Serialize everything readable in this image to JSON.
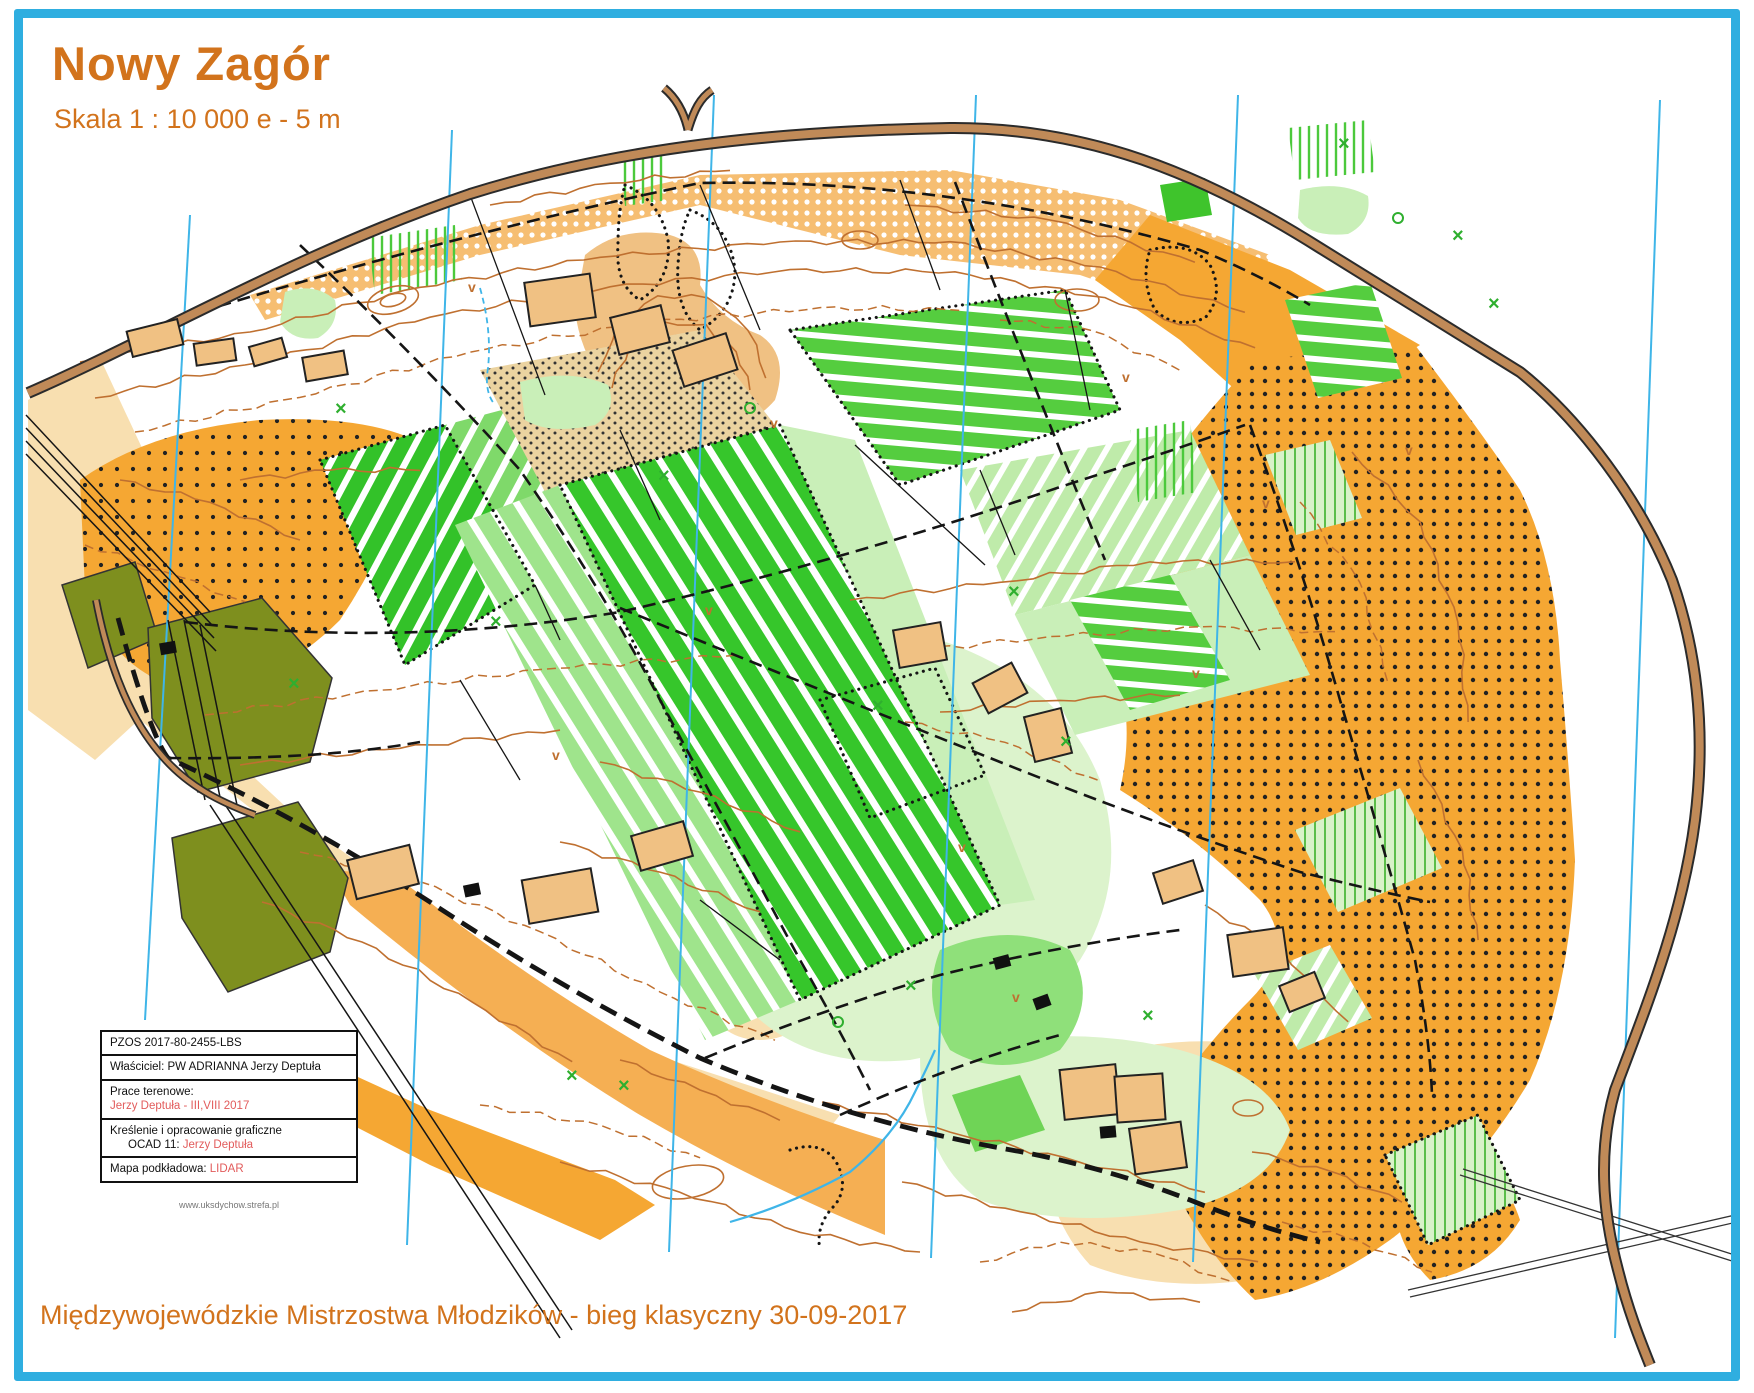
{
  "header": {
    "title": "Nowy Zagór",
    "scale_note": "Skala 1 : 10 000 e - 5 m"
  },
  "credits_box": {
    "registry": "PZOS 2017-80-2455-LBS",
    "owner": "Właściciel: PW ADRIANNA Jerzy Deptuła",
    "fieldwork_label": "Prace terenowe:",
    "fieldwork_value": "Jerzy Deptuła - III,VIII 2017",
    "drafting_label": "Kreślenie i opracowanie graficzne",
    "drafting_sub_label": "OCAD 11:",
    "drafting_value": "Jerzy Deptuła",
    "basemap_label": "Mapa podkładowa:",
    "basemap_value": "LIDAR",
    "website": "www.uksdychow.strefa.pl"
  },
  "footer": {
    "event_caption": "Międzywojewódzkie Mistrzostwa Młodzików - bieg klasyczny 30-09-2017"
  },
  "palette": {
    "accent": "#D2731C",
    "red": "#E25B5B",
    "frame": "#2FAEE0",
    "meridian": "#3FB5E8",
    "contour": "#BF7030",
    "road": "#C08A58",
    "roadcase": "#2b2b2b",
    "ink": "#151515"
  }
}
